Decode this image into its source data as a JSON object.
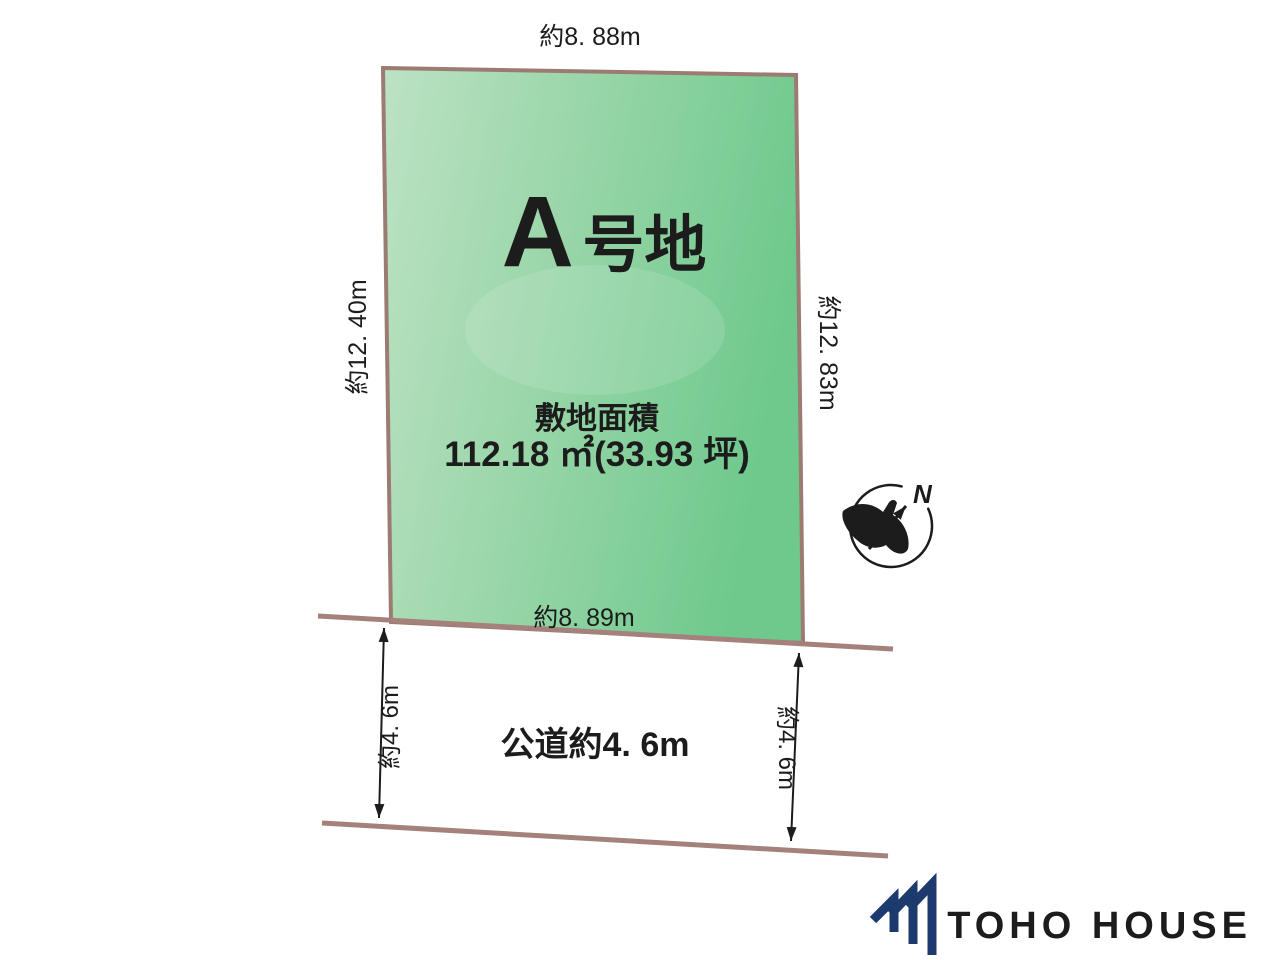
{
  "diagram": {
    "plot": {
      "name_prefix": "A",
      "name_suffix": "号地",
      "area_title": "敷地面積",
      "area_value": "112.18 ㎡(33.93 坪)",
      "dimensions": {
        "top": "約8. 88m",
        "left": "約12. 40m",
        "right": "約12. 83m",
        "bottom": "約8. 89m"
      }
    },
    "road": {
      "label": "公道約4. 6m",
      "width_left": "約4. 6m",
      "width_right": "約4. 6m"
    },
    "compass": {
      "north": "N"
    },
    "colors": {
      "plot_fill_left": "#b9e0c1",
      "plot_fill_right": "#6fc98d",
      "boundary": "#9c7b72",
      "brand_navy": "#1c3a6d"
    }
  },
  "footer": {
    "brand": "TOHO HOUSE"
  }
}
